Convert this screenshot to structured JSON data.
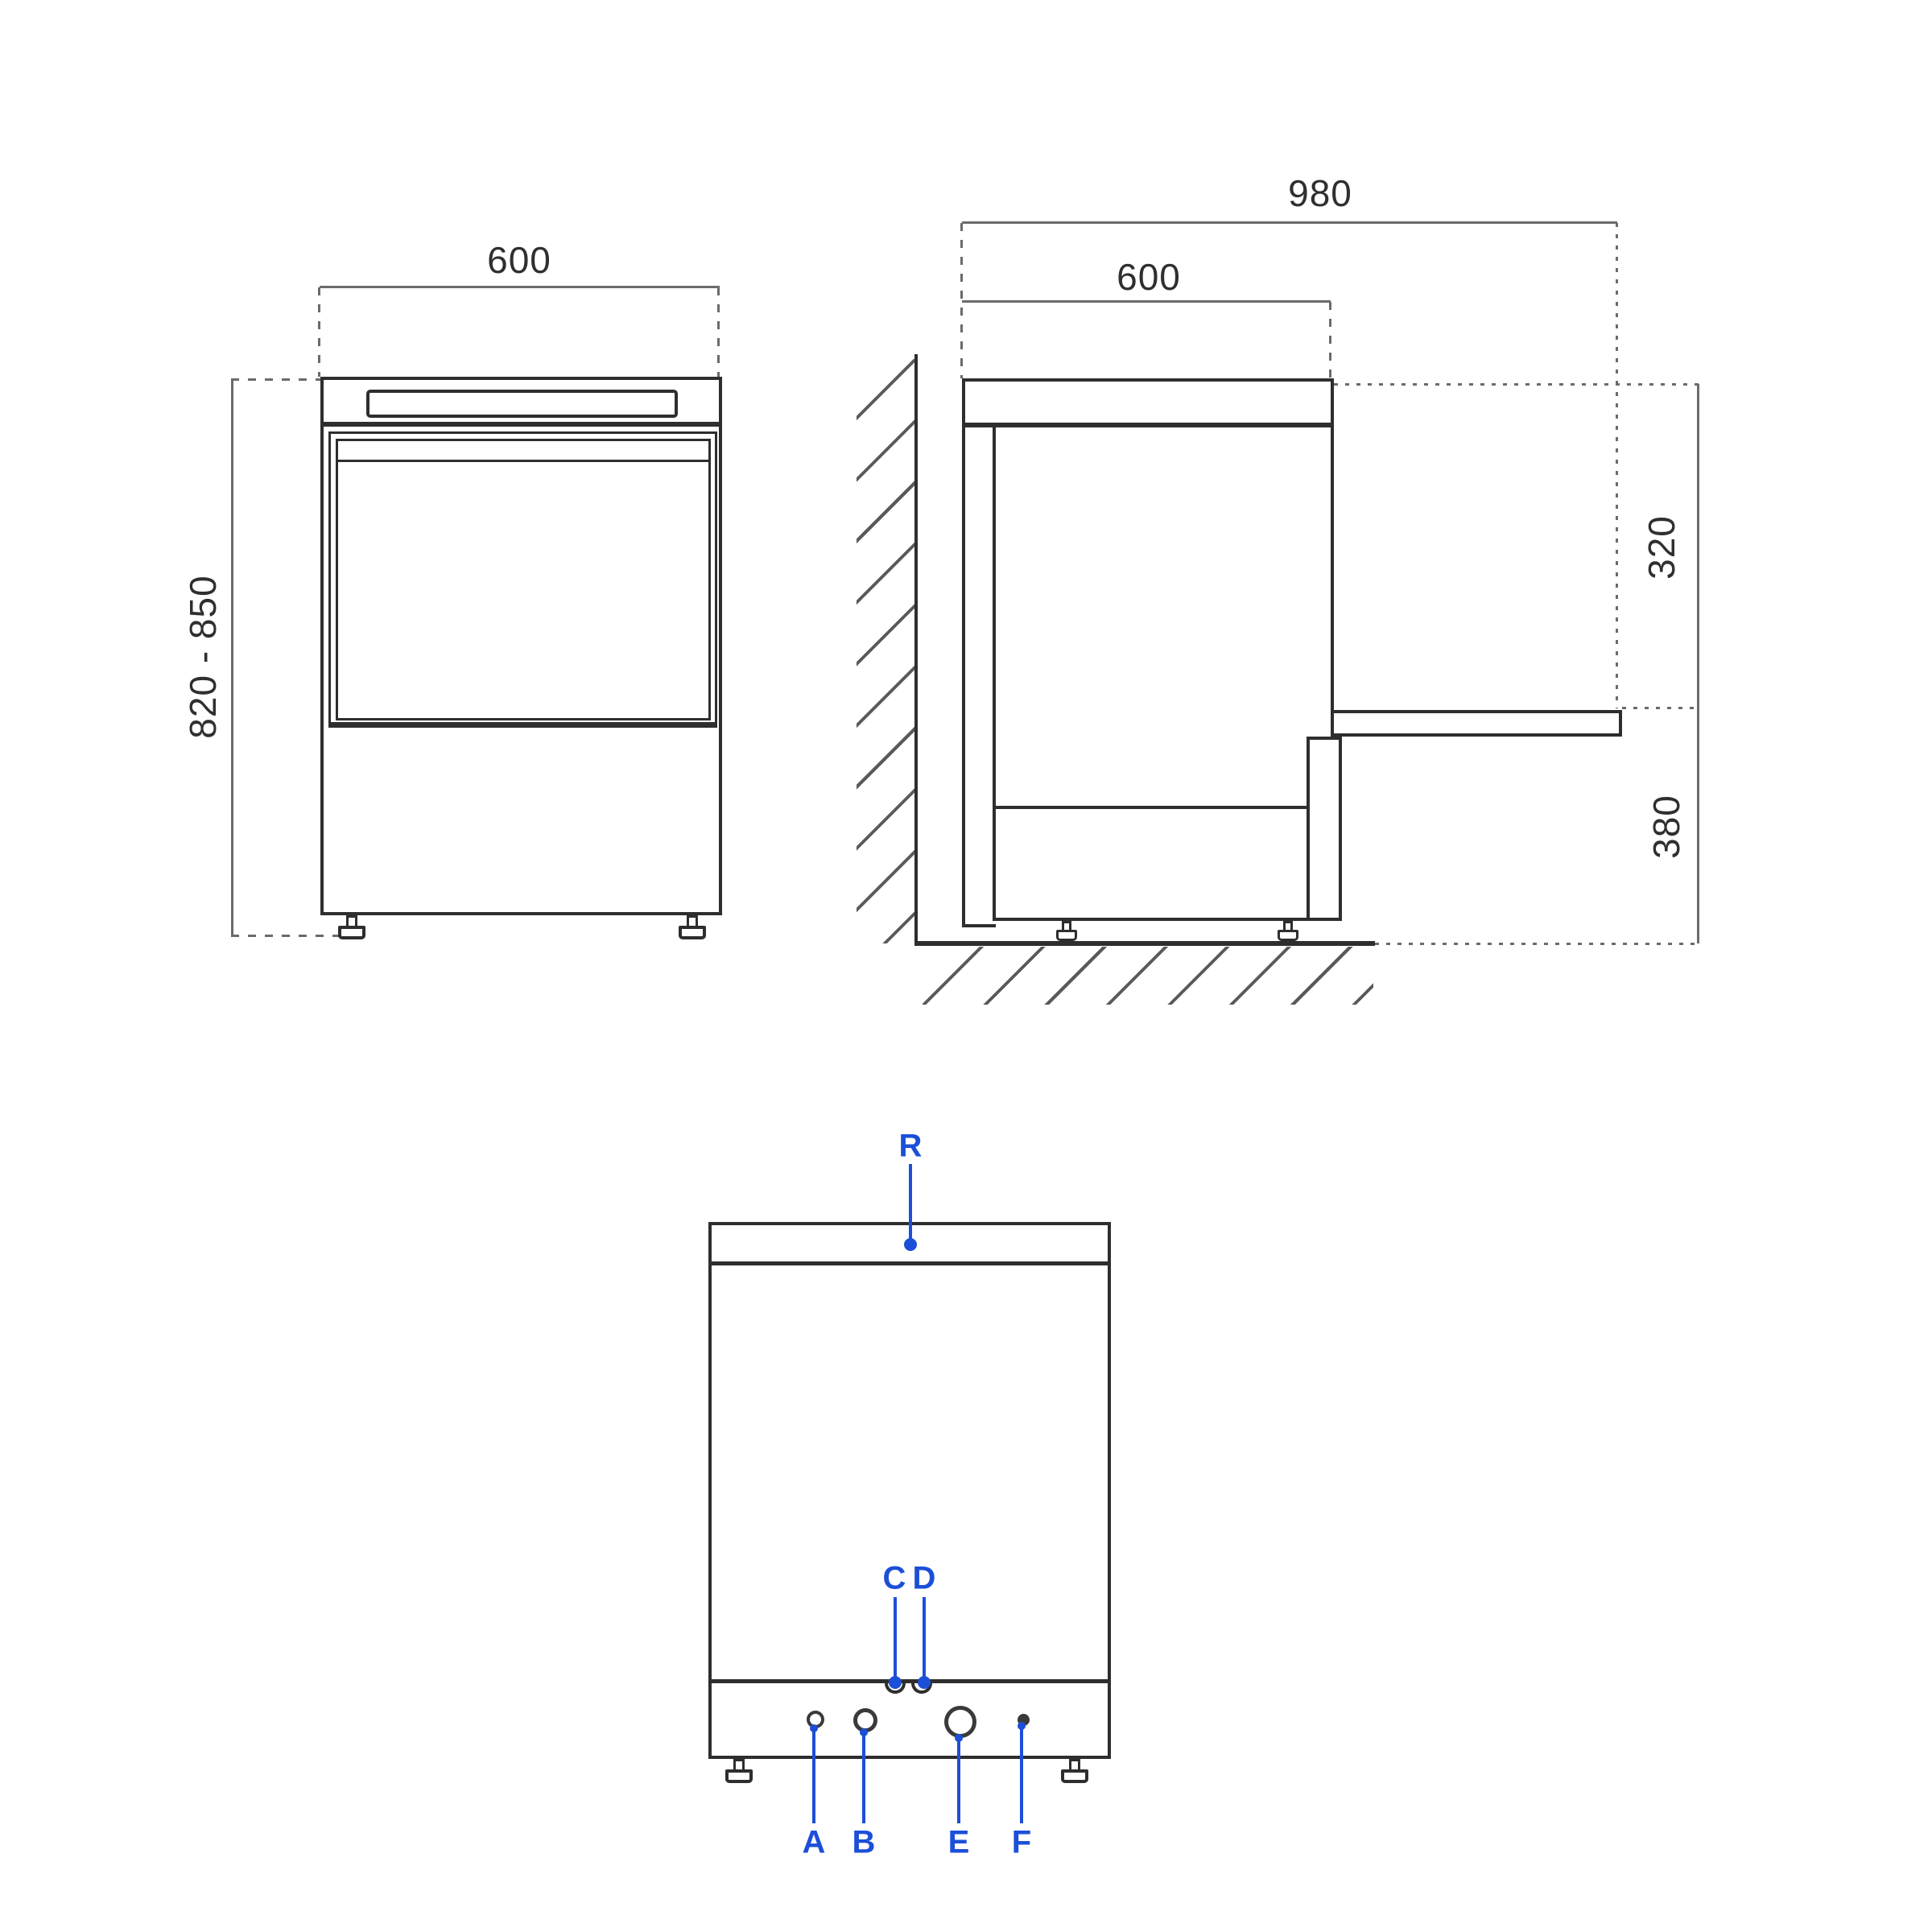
{
  "diagram": {
    "kind": "undercounter-dishwasher-dimension-drawing",
    "colors": {
      "line": "#2e2e2e",
      "dimension": "#6b6b6b",
      "accent_blue": "#1c4fd8",
      "background": "#ffffff"
    }
  },
  "front_view": {
    "width_label": "600",
    "height_label": "820 - 850"
  },
  "side_view": {
    "overall_depth_label": "980",
    "body_depth_label": "600",
    "door_to_top_label": "320",
    "door_to_floor_label": "380"
  },
  "rear_view": {
    "connection_r": "R",
    "connection_c": "C",
    "connection_d": "D",
    "connection_a": "A",
    "connection_b": "B",
    "connection_e": "E",
    "connection_f": "F"
  }
}
